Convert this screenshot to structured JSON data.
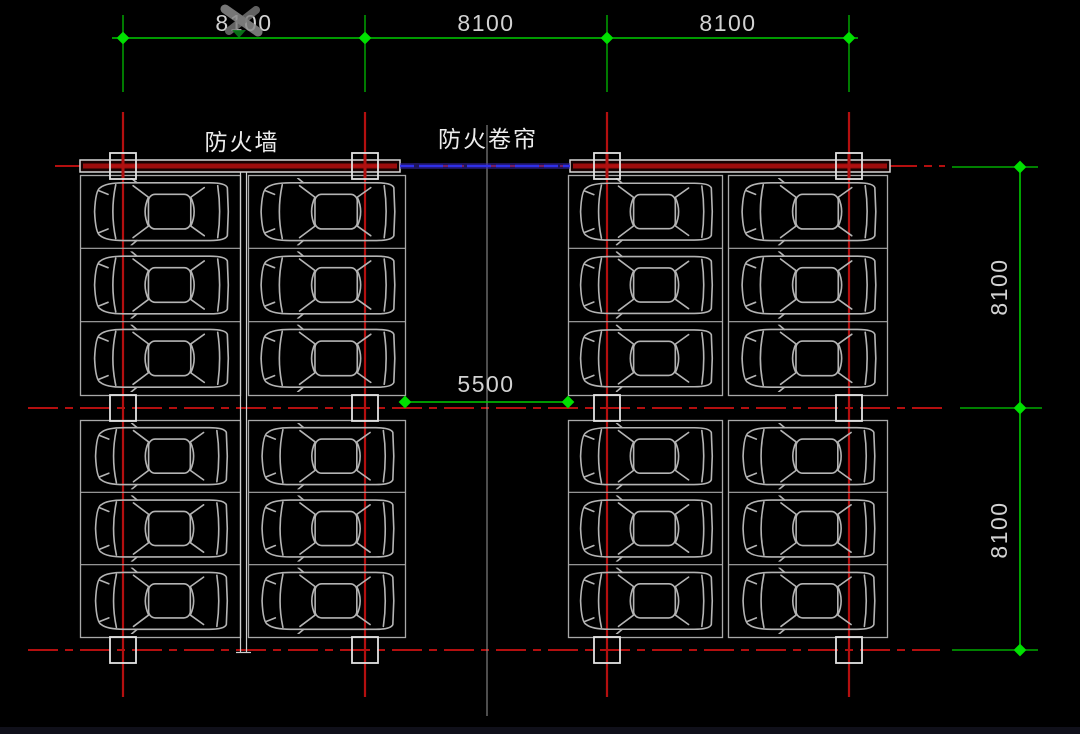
{
  "labels": {
    "fire_wall": "防火墙",
    "fire_shutter": "防火卷帘"
  },
  "dimensions": {
    "top": {
      "labels": [
        "8100",
        "8100",
        "8100"
      ]
    },
    "right": {
      "labels": [
        "8100",
        "8100"
      ]
    },
    "aisle": {
      "label": "5500"
    }
  },
  "plan_summary": {
    "type": "underground-parking-garage-floor-plan",
    "bay_widths_mm": [
      8100,
      8100,
      8100
    ],
    "bay_depths_mm": [
      8100,
      8100
    ],
    "aisle_width_mm": 5500,
    "parking_blocks": 4,
    "spaces_per_block": 6,
    "total_parked_cars": 24,
    "fire_separation": [
      "fire wall between left twin columns",
      "fire shutter across center aisle opening"
    ]
  },
  "colors": {
    "background": "#000000",
    "grid_line": "#b40f0f",
    "wall_red": "#9c0c0c",
    "dimension": "#00cc00",
    "tick": "#00e000",
    "dimension_text": "#d2d2d2",
    "car_outline": "#b4b4b4",
    "block_outline": "#a8a8a8",
    "wall_outline": "#d8d8d8",
    "column_outline": "#e2e2e2",
    "shutter_blue": "#2f2fe8",
    "shutter_glow": "#3c28b4",
    "center_line": "#9a9a9a",
    "label_text": "#ececec"
  }
}
